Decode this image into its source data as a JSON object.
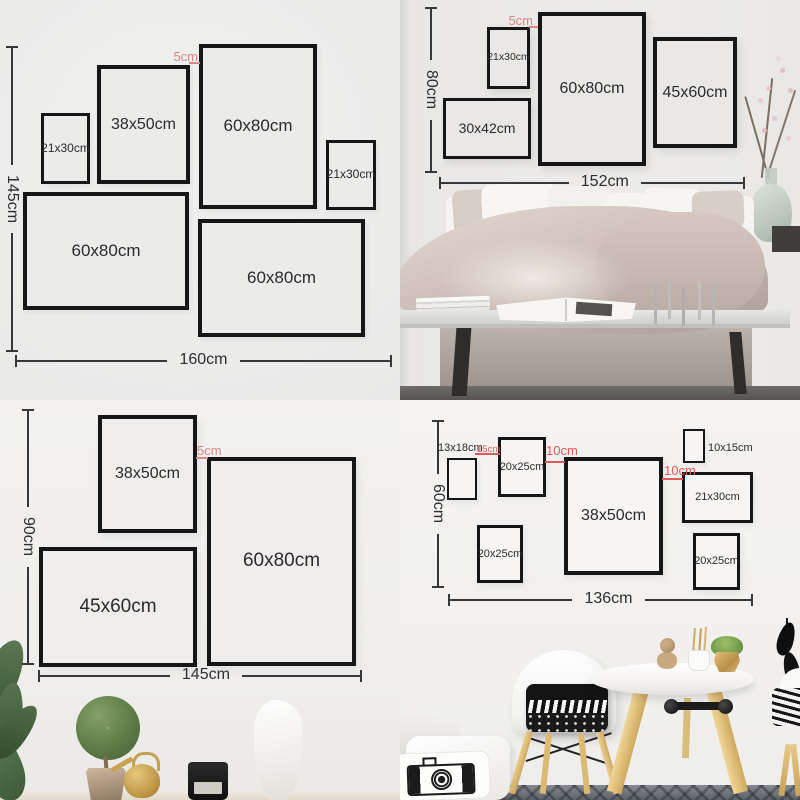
{
  "colors": {
    "frame_border": "#161616",
    "red_annotation_soft": "#d98888",
    "red_annotation_strong": "#e05a5a"
  },
  "quadrants": {
    "tl": {
      "dim_vertical": "145cm",
      "dim_horizontal": "160cm",
      "gap_label": "5cm",
      "frames": [
        {
          "label": "21x30cm"
        },
        {
          "label": "38x50cm"
        },
        {
          "label": "60x80cm"
        },
        {
          "label": "21x30cm"
        },
        {
          "label": "60x80cm"
        },
        {
          "label": "60x80cm"
        }
      ]
    },
    "tr": {
      "dim_vertical": "80cm",
      "dim_horizontal": "152cm",
      "gap_label": "5cm",
      "frames": [
        {
          "label": "21x30cm"
        },
        {
          "label": "60x80cm"
        },
        {
          "label": "45x60cm"
        },
        {
          "label": "30x42cm"
        }
      ]
    },
    "bl": {
      "dim_vertical": "90cm",
      "dim_horizontal": "145cm",
      "gap_label": "5cm",
      "frames": [
        {
          "label": "38x50cm"
        },
        {
          "label": "60x80cm"
        },
        {
          "label": "45x60cm"
        }
      ]
    },
    "br": {
      "dim_vertical": "60cm",
      "dim_horizontal": "136cm",
      "gap_labels": [
        "15cm",
        "10cm",
        "10cm"
      ],
      "frames": [
        {
          "label": "13x18cm"
        },
        {
          "label": "20x25cm"
        },
        {
          "label": "38x50cm"
        },
        {
          "label": "10x15cm"
        },
        {
          "label": "21x30cm"
        },
        {
          "label": "20x25cm"
        },
        {
          "label": "20x25cm"
        }
      ]
    }
  }
}
